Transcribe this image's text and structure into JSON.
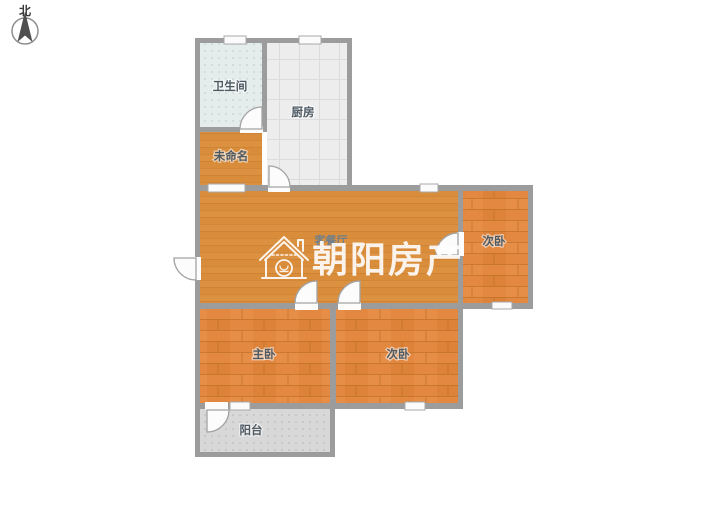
{
  "compass": {
    "label": "北"
  },
  "watermark": {
    "text": "朝阳房产"
  },
  "rooms": {
    "bathroom": {
      "label": "卫生间"
    },
    "kitchen": {
      "label": "厨房"
    },
    "unnamed": {
      "label": "未命名"
    },
    "living": {
      "label": "客餐厅"
    },
    "bedroom_top_right": {
      "label": "次卧"
    },
    "master_bedroom": {
      "label": "主卧"
    },
    "bedroom_bottom": {
      "label": "次卧"
    },
    "balcony": {
      "label": "阳台"
    }
  },
  "colors": {
    "wall": "#9c9c9c",
    "wood_floor": "#d98c3a",
    "wood_floor_light": "#e0984a",
    "plank_floor": "#e28840",
    "plank_line": "#c06f26",
    "bath_tile": "#e4edeb",
    "bath_dot": "#bfd4cf",
    "kitchen_tile": "#ededed",
    "kitchen_grid": "#dcdcdc",
    "balcony_tile": "#d8d8d8",
    "balcony_dot": "#bdbdbd",
    "label": "#4e5a63",
    "watermark": "#ffffff"
  }
}
